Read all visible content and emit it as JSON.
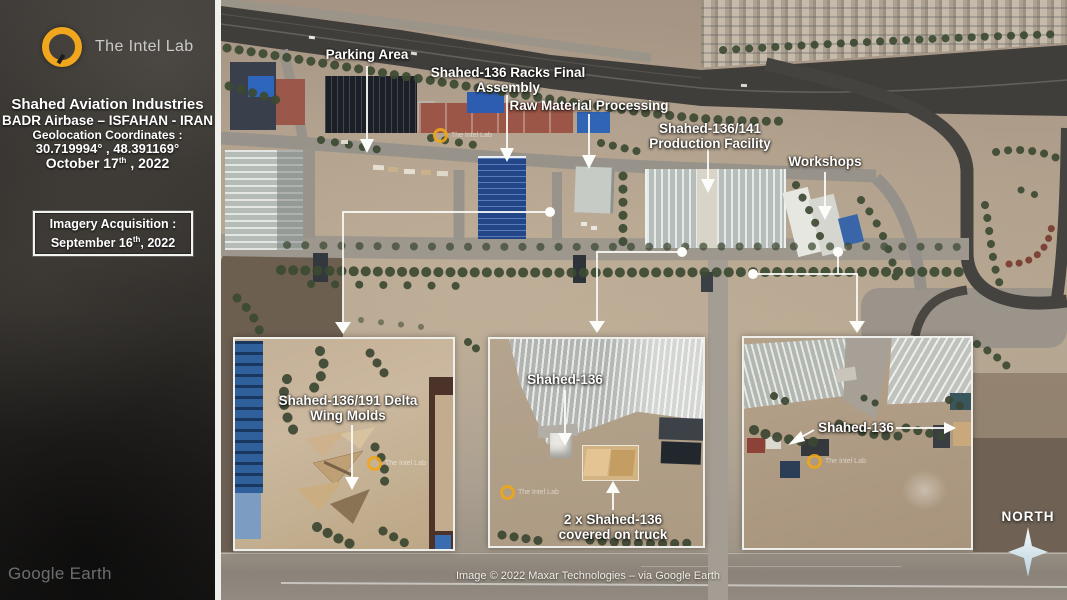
{
  "colors": {
    "accent_orange": "#f0a61d",
    "annotation_white": "#fdfdfc",
    "divider_white": "#efefeb"
  },
  "sidebar": {
    "brand": "The Intel Lab",
    "title": "Shahed Aviation Industries",
    "subtitle": "BADR Airbase – ISFAHAN - IRAN",
    "geo_label": "Geolocation Coordinates :",
    "coordinates": "30.719994° , 48.391169°",
    "date_prefix": "October 17",
    "date_sup": "th",
    "date_suffix": " , 2022",
    "acquisition": {
      "label": "Imagery Acquisition :",
      "date_prefix": "September 16",
      "date_sup": "th",
      "date_suffix": ", 2022"
    }
  },
  "annotations": {
    "parking": "Parking Area",
    "racks_line1": "Shahed-136 Racks Final",
    "racks_line2": "Assembly",
    "raw_material": "Raw Material Processing",
    "production_line1": "Shahed-136/141",
    "production_line2": "Production Facility",
    "workshops": "Workshops"
  },
  "insets": {
    "left": {
      "label_line1": "Shahed-136/191 Delta",
      "label_line2": "Wing Molds"
    },
    "middle": {
      "label_top": "Shahed-136",
      "label_bottom_line1": "2 x Shahed-136",
      "label_bottom_line2": "covered on truck"
    },
    "right": {
      "label": "Shahed-136"
    }
  },
  "compass": {
    "label": "NORTH"
  },
  "watermark": {
    "intel_lab": "The Intel Lab",
    "google_earth": "Google Earth"
  },
  "footer": {
    "copyright": "Image © 2022 Maxar Technologies – via Google Earth"
  }
}
